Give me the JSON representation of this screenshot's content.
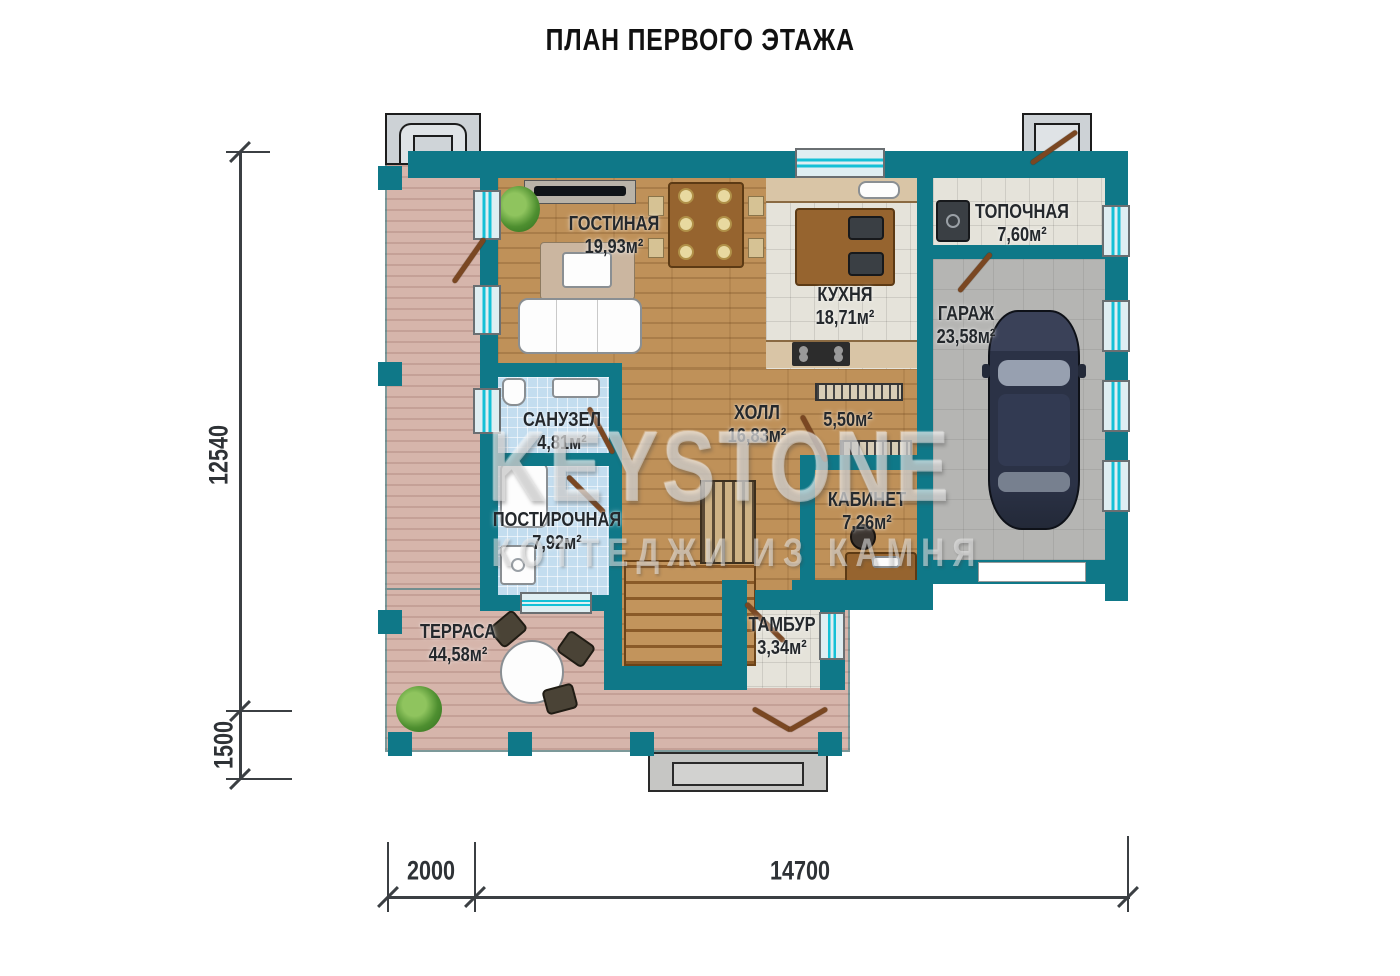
{
  "title": "ПЛАН ПЕРВОГО ЭТАЖА",
  "watermark": {
    "brand": "KEYSTONE",
    "tagline": "КОТТЕДЖИ ИЗ КАМНЯ"
  },
  "rooms": [
    {
      "id": "living",
      "name": "ГОСТИНАЯ",
      "area": "19,93м²"
    },
    {
      "id": "kitchen",
      "name": "КУХНЯ",
      "area": "18,71м²"
    },
    {
      "id": "boiler",
      "name": "ТОПОЧНАЯ",
      "area": "7,60м²"
    },
    {
      "id": "garage",
      "name": "ГАРАЖ",
      "area": "23,58м²"
    },
    {
      "id": "bathroom",
      "name": "САНУЗЕЛ",
      "area": "4,81м²"
    },
    {
      "id": "hall",
      "name": "ХОЛЛ",
      "area": "16,83м²"
    },
    {
      "id": "stairwell",
      "name": "",
      "area": "5,50м²"
    },
    {
      "id": "office",
      "name": "КАБИНЕТ",
      "area": "7,26м²"
    },
    {
      "id": "laundry",
      "name": "ПОСТИРОЧНАЯ",
      "area": "7,92м²"
    },
    {
      "id": "vestibule",
      "name": "ТАМБУР",
      "area": "3,34м²"
    },
    {
      "id": "terrace",
      "name": "ТЕРРАСА",
      "area": "44,58м²"
    }
  ],
  "dimensions": {
    "left_total": "12540",
    "left_lower": "1500",
    "bottom_left": "2000",
    "bottom_main": "14700"
  },
  "colors": {
    "wall": "#0f7888",
    "window_accent": "#14c0d6",
    "terrace_deck": "#d6b5ab",
    "wood_floor": "#bf9159",
    "tile_floor": "#e5e3da",
    "blue_tile": "#c3ddef",
    "garage_floor": "#b5b5b3",
    "door": "#7a4722",
    "dimension_line": "#3b3f43"
  }
}
